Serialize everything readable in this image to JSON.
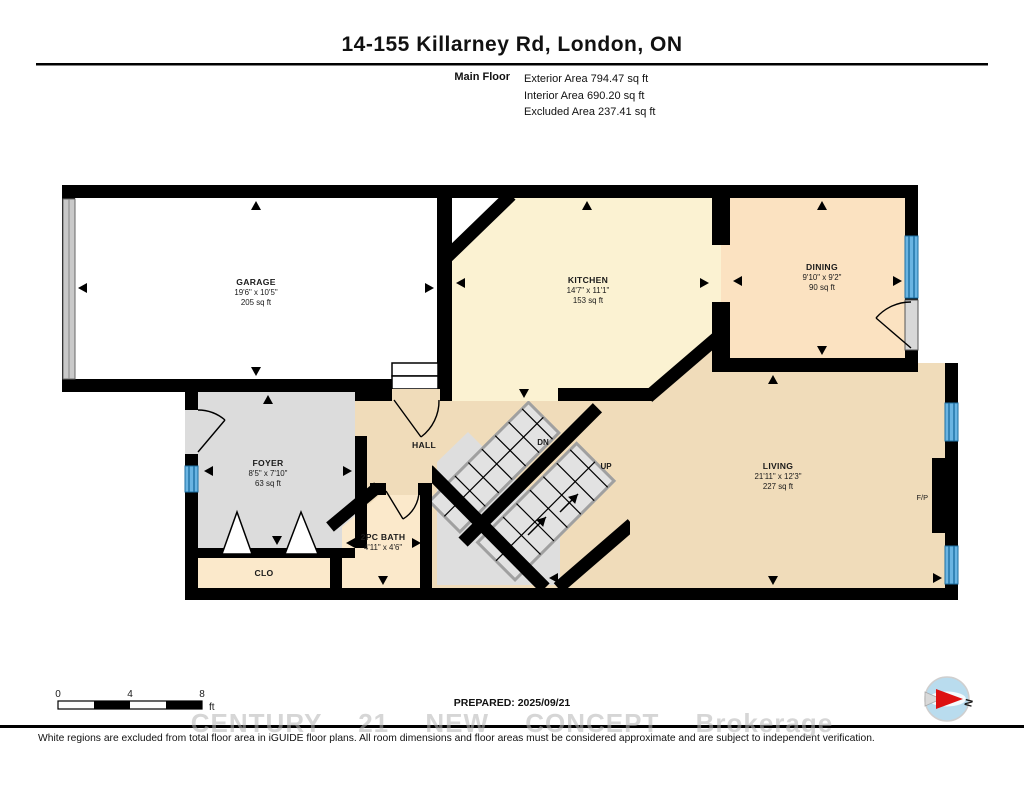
{
  "header": {
    "title": "14-155 Killarney Rd, London, ON",
    "floor_label": "Main Floor",
    "stats": [
      "Exterior Area 794.47 sq ft",
      "Interior Area 690.20 sq ft",
      "Excluded Area 237.41 sq ft"
    ]
  },
  "rooms": {
    "garage": {
      "name": "GARAGE",
      "dims": "19'6\" x 10'5\"",
      "area": "205 sq ft"
    },
    "kitchen": {
      "name": "KITCHEN",
      "dims": "14'7\" x 11'1\"",
      "area": "153 sq ft"
    },
    "dining": {
      "name": "DINING",
      "dims": "9'10\" x 9'2\"",
      "area": "90 sq ft"
    },
    "living": {
      "name": "LIVING",
      "dims": "21'11\" x 12'3\"",
      "area": "227 sq ft"
    },
    "foyer": {
      "name": "FOYER",
      "dims": "8'5\" x 7'10\"",
      "area": "63 sq ft"
    },
    "bath": {
      "name": "2PC BATH",
      "dims": "4'11\" x 4'6\""
    },
    "hall": {
      "name": "HALL"
    },
    "closet": {
      "name": "CLO"
    }
  },
  "stairs": {
    "down": "DN",
    "up": "UP"
  },
  "fireplace_label": "F/P",
  "footer": {
    "scale_ticks": [
      "0",
      "4",
      "8"
    ],
    "scale_unit": "ft",
    "prepared": "PREPARED: 2025/09/21",
    "compass_label": "N",
    "watermark": "CENTURY 21 NEW CONCEPT Brokerage",
    "disclaimer": "White regions are excluded from total floor area in iGUIDE floor plans. All room dimensions and floor areas must be considered approximate and are subject to independent verification."
  },
  "colors": {
    "wall": "#000000",
    "garage_floor": "#ffffff",
    "kitchen_floor": "#fbf2d2",
    "dining_floor": "#fbe2c1",
    "living_floor": "#f0dcba",
    "foyer_floor": "#dcdcdc",
    "bath_floor": "#fbe9cb",
    "stairs_floor": "#e2e2e2",
    "window_fill": "#6ab4e2",
    "window_line": "#1d6fa3",
    "compass_red": "#dd1111"
  }
}
